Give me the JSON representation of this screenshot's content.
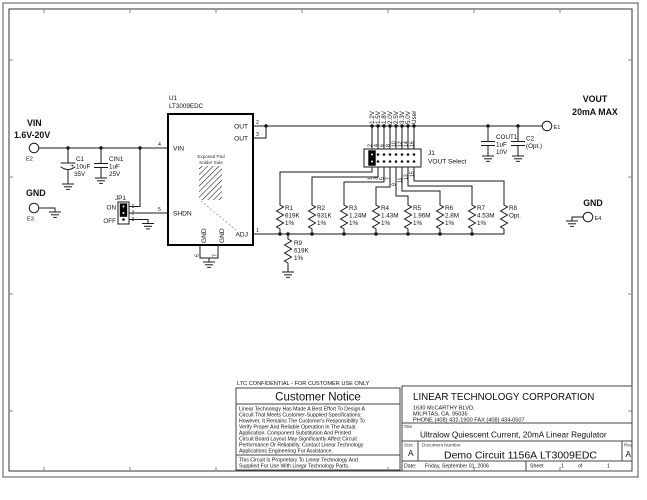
{
  "sheet": {
    "confidential": "LTC CONFIDENTIAL - FOR CUSTOMER USE ONLY"
  },
  "input": {
    "label": "VIN",
    "range": "1.6V-20V",
    "terminal": "E2"
  },
  "gnd_left": {
    "label": "GND",
    "terminal": "E3"
  },
  "output": {
    "label": "VOUT",
    "max": "20mA MAX",
    "terminal": "E1"
  },
  "gnd_right": {
    "label": "GND",
    "terminal": "E4"
  },
  "caps": {
    "c1": {
      "ref": "C1",
      "plus": "+",
      "value": "10uF",
      "voltage": "35V"
    },
    "cin1": {
      "ref": "CIN1",
      "value": "1uF",
      "voltage": "25V"
    },
    "cout1": {
      "ref": "COUT1",
      "value": "1uF",
      "voltage": "10V"
    },
    "c2": {
      "ref": "C2",
      "value": "(Opt.)"
    }
  },
  "jp1": {
    "ref": "JP1",
    "on_label": "ON",
    "off_label": "OFF",
    "pins": [
      "1",
      "2",
      "3"
    ]
  },
  "u1": {
    "ref": "U1",
    "part": "LT3009EDC",
    "pin_vin": "VIN",
    "pin_shdn": "SHDN",
    "pin_out1": "OUT",
    "pin_out2": "OUT",
    "pin_adj": "ADJ",
    "pin_gnd1": "GND",
    "pin_gnd2": "GND",
    "num_vin": "4",
    "num_shdn": "5",
    "num_out1": "2",
    "num_out2": "3",
    "num_adj": "1",
    "num_gnd1": "6",
    "num_gnd2": "7",
    "pad_line1": "Exposed Pad",
    "pad_line2": "Solder Side"
  },
  "j1": {
    "ref": "J1",
    "name": "VOUT Select",
    "options": [
      "1.2V",
      "1.5V",
      "1.8V",
      "2.0V",
      "2.5V",
      "3.3V",
      "5.0V",
      "User"
    ],
    "top_pins": [
      "2",
      "4",
      "6",
      "8",
      "10",
      "12",
      "14",
      "16"
    ],
    "bottom_pins": [
      "1",
      "3",
      "5",
      "7",
      "9",
      "11",
      "13",
      "15"
    ]
  },
  "resistors": [
    {
      "ref": "R1",
      "value": "619K",
      "tol": "1%"
    },
    {
      "ref": "R2",
      "value": "931K",
      "tol": "1%"
    },
    {
      "ref": "R3",
      "value": "1.24M",
      "tol": "1%"
    },
    {
      "ref": "R4",
      "value": "1.43M",
      "tol": "1%"
    },
    {
      "ref": "R5",
      "value": "1.96M",
      "tol": "1%"
    },
    {
      "ref": "R6",
      "value": "2.8M",
      "tol": "1%"
    },
    {
      "ref": "R7",
      "value": "4.53M",
      "tol": "1%"
    },
    {
      "ref": "R8",
      "value": "Opt.",
      "tol": ""
    },
    {
      "ref": "R9",
      "value": "619K",
      "tol": "1%"
    }
  ],
  "notice": {
    "title": "Customer Notice",
    "body": [
      "Linear Technology Has Made A Best Effort To Design A",
      "Circuit That Meets Customer-Supplied Specifications;",
      "However, It Remains The Customer's Responsibility To",
      "Verify Proper And Reliable Operation In The Actual",
      "Application. Component Substitution And Printed",
      "Circuit Board Layout May Significantly Affect Circuit",
      "Performance Or Reliability. Contact Linear Technology",
      "Applications Engineering For Assistance."
    ],
    "footer": [
      "This Circuit Is Proprietary To Linear Technology And",
      "Supplied For Use With Linear Technology Parts."
    ]
  },
  "titleblock": {
    "company": "LINEAR TECHNOLOGY CORPORATION",
    "address1": "1630 McCARTHY BLVD.",
    "address2": "MILPITAS, CA. 95035",
    "address3": "PHONE (408) 432-1900  FAX (408) 434-0507",
    "title_label": "Title",
    "title": "Ultralow Quiescent Current, 20mA Linear Regulator",
    "size_label": "Size",
    "size": "A",
    "doc_label": "Document Number",
    "doc_number": "Demo Circuit 1156A",
    "doc_part": "LT3009EDC",
    "rev_label": "Rev",
    "rev": "A",
    "date_label": "Date:",
    "date": "Friday, September 01, 2006",
    "sheet_label": "Sheet",
    "sheet_num": "1",
    "of_label": "of",
    "sheet_total": "1"
  }
}
